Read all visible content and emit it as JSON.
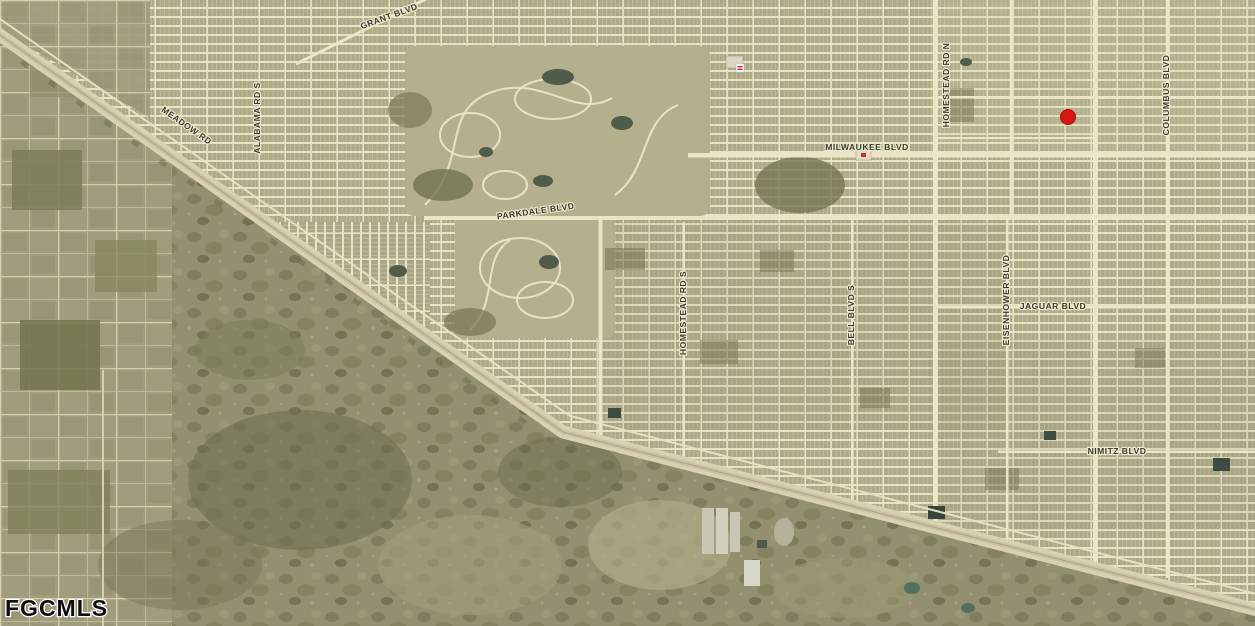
{
  "map": {
    "watermark": "FGCMLS",
    "marker": {
      "color": "#d91712"
    },
    "road_labels": [
      {
        "id": "grant-blvd",
        "text": "GRANT BLVD"
      },
      {
        "id": "meadow-rd",
        "text": "MEADOW RD"
      },
      {
        "id": "alabama-rd-s",
        "text": "ALABAMA RD S"
      },
      {
        "id": "parkdale-blvd",
        "text": "PARKDALE BLVD"
      },
      {
        "id": "milwaukee-blvd",
        "text": "MILWAUKEE BLVD"
      },
      {
        "id": "homestead-rd-s",
        "text": "HOMESTEAD RD S"
      },
      {
        "id": "homestead-rd-n",
        "text": "HOMESTEAD RD N"
      },
      {
        "id": "bell-blvd-s",
        "text": "BELL BLVD S"
      },
      {
        "id": "eisenhower-blvd",
        "text": "EISENHOWER BLVD"
      },
      {
        "id": "jaguar-blvd",
        "text": "JAGUAR BLVD"
      },
      {
        "id": "columbus-blvd",
        "text": "COLUMBUS BLVD"
      },
      {
        "id": "nimitz-blvd",
        "text": "NIMITZ BLVD"
      }
    ],
    "colors": {
      "street_cream": "#ebe5c5",
      "parcel_khaki": "#adaa8a",
      "vegetation_olive": "#6e6e4c",
      "highway_tan": "#d8d2b1",
      "pond_dark": "#3d4c40",
      "label_ink": "#3b3b32"
    }
  }
}
